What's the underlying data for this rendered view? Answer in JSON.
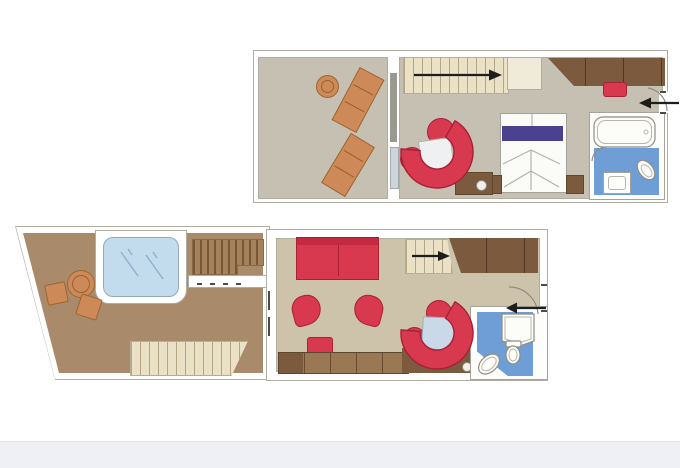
{
  "document": {
    "type": "floor-plan",
    "title": "duplex-suite-two-level-floor-plan",
    "visible_text": [],
    "decks": 2
  },
  "palette": {
    "page_bg": "#ffffff",
    "footer_band": "#eff0f5",
    "footer_edge": "#e3e4ea",
    "wall_white": "#ffffff",
    "wall_outline": "#b0aea3",
    "floor_upper": "#c6c0b2",
    "floor_terrace": "#a98b6b",
    "floor_living": "#cdc3ab",
    "stair_cream": "#ebe1c7",
    "wood_dark": "#7b5a3e",
    "wood_mid": "#9a7853",
    "wood_deck": "#a5815c",
    "furniture_red": "#d8394e",
    "furniture_red_dark": "#c32940",
    "lounger_orange": "#cd8a58",
    "bed_purple": "#4a418f",
    "bath_floor_blue": "#6f9ed6",
    "hot_tub_blue": "#c2dcee",
    "dining_table_blue": "#c9d9e8",
    "glass_pane_blue": "#ccd6da",
    "divider_grey": "#9b998f",
    "fixture_white": "#fcfcf9",
    "table_white": "#eef0f1",
    "arrow_black": "#1d1d1b"
  },
  "upper_deck": {
    "label": "upper-level",
    "rooms": [
      {
        "name": "balcony",
        "furniture": [
          "sun-lounger",
          "sun-lounger",
          "round-side-table"
        ],
        "divider": "glass-sliding-door"
      },
      {
        "name": "bedroom",
        "furniture": [
          "staircase-with-up-arrow",
          "double-bed-with-purple-pillow-band",
          "nightstand-left",
          "nightstand-right",
          "curved-sofa",
          "round-chair",
          "round-chair",
          "square-coffee-table",
          "wardrobe-dark-wood",
          "red-stool",
          "minibar-cabinet"
        ]
      },
      {
        "name": "bathroom",
        "furniture": [
          "bathtub",
          "washbasin",
          "toilet"
        ],
        "door": "swing-arc"
      }
    ],
    "annotations": [
      "staircase-direction-arrow-right",
      "entrance-arrow-left",
      "entrance-door-swing"
    ]
  },
  "lower_deck": {
    "label": "lower-level",
    "rooms": [
      {
        "name": "private-terrace",
        "furniture": [
          "hot-tub-whirlpool",
          "round-table",
          "deck-chair",
          "deck-chair",
          "wood-deck-steps",
          "terrace-staircase"
        ]
      },
      {
        "name": "living-room",
        "furniture": [
          "red-sofa",
          "oval-glass-table",
          "tub-chair",
          "tub-chair",
          "red-ottoman",
          "sideboard",
          "staircase-with-up-arrow",
          "wardrobe-dark-wood",
          "curved-dining-sofa",
          "round-chair",
          "round-chair",
          "square-dining-table"
        ]
      },
      {
        "name": "bathroom",
        "furniture": [
          "shower",
          "toilet",
          "washbasin"
        ],
        "door": "swing-arc"
      }
    ],
    "annotations": [
      "staircase-direction-arrow-right",
      "entrance-arrow-left",
      "entrance-door-swing"
    ]
  }
}
